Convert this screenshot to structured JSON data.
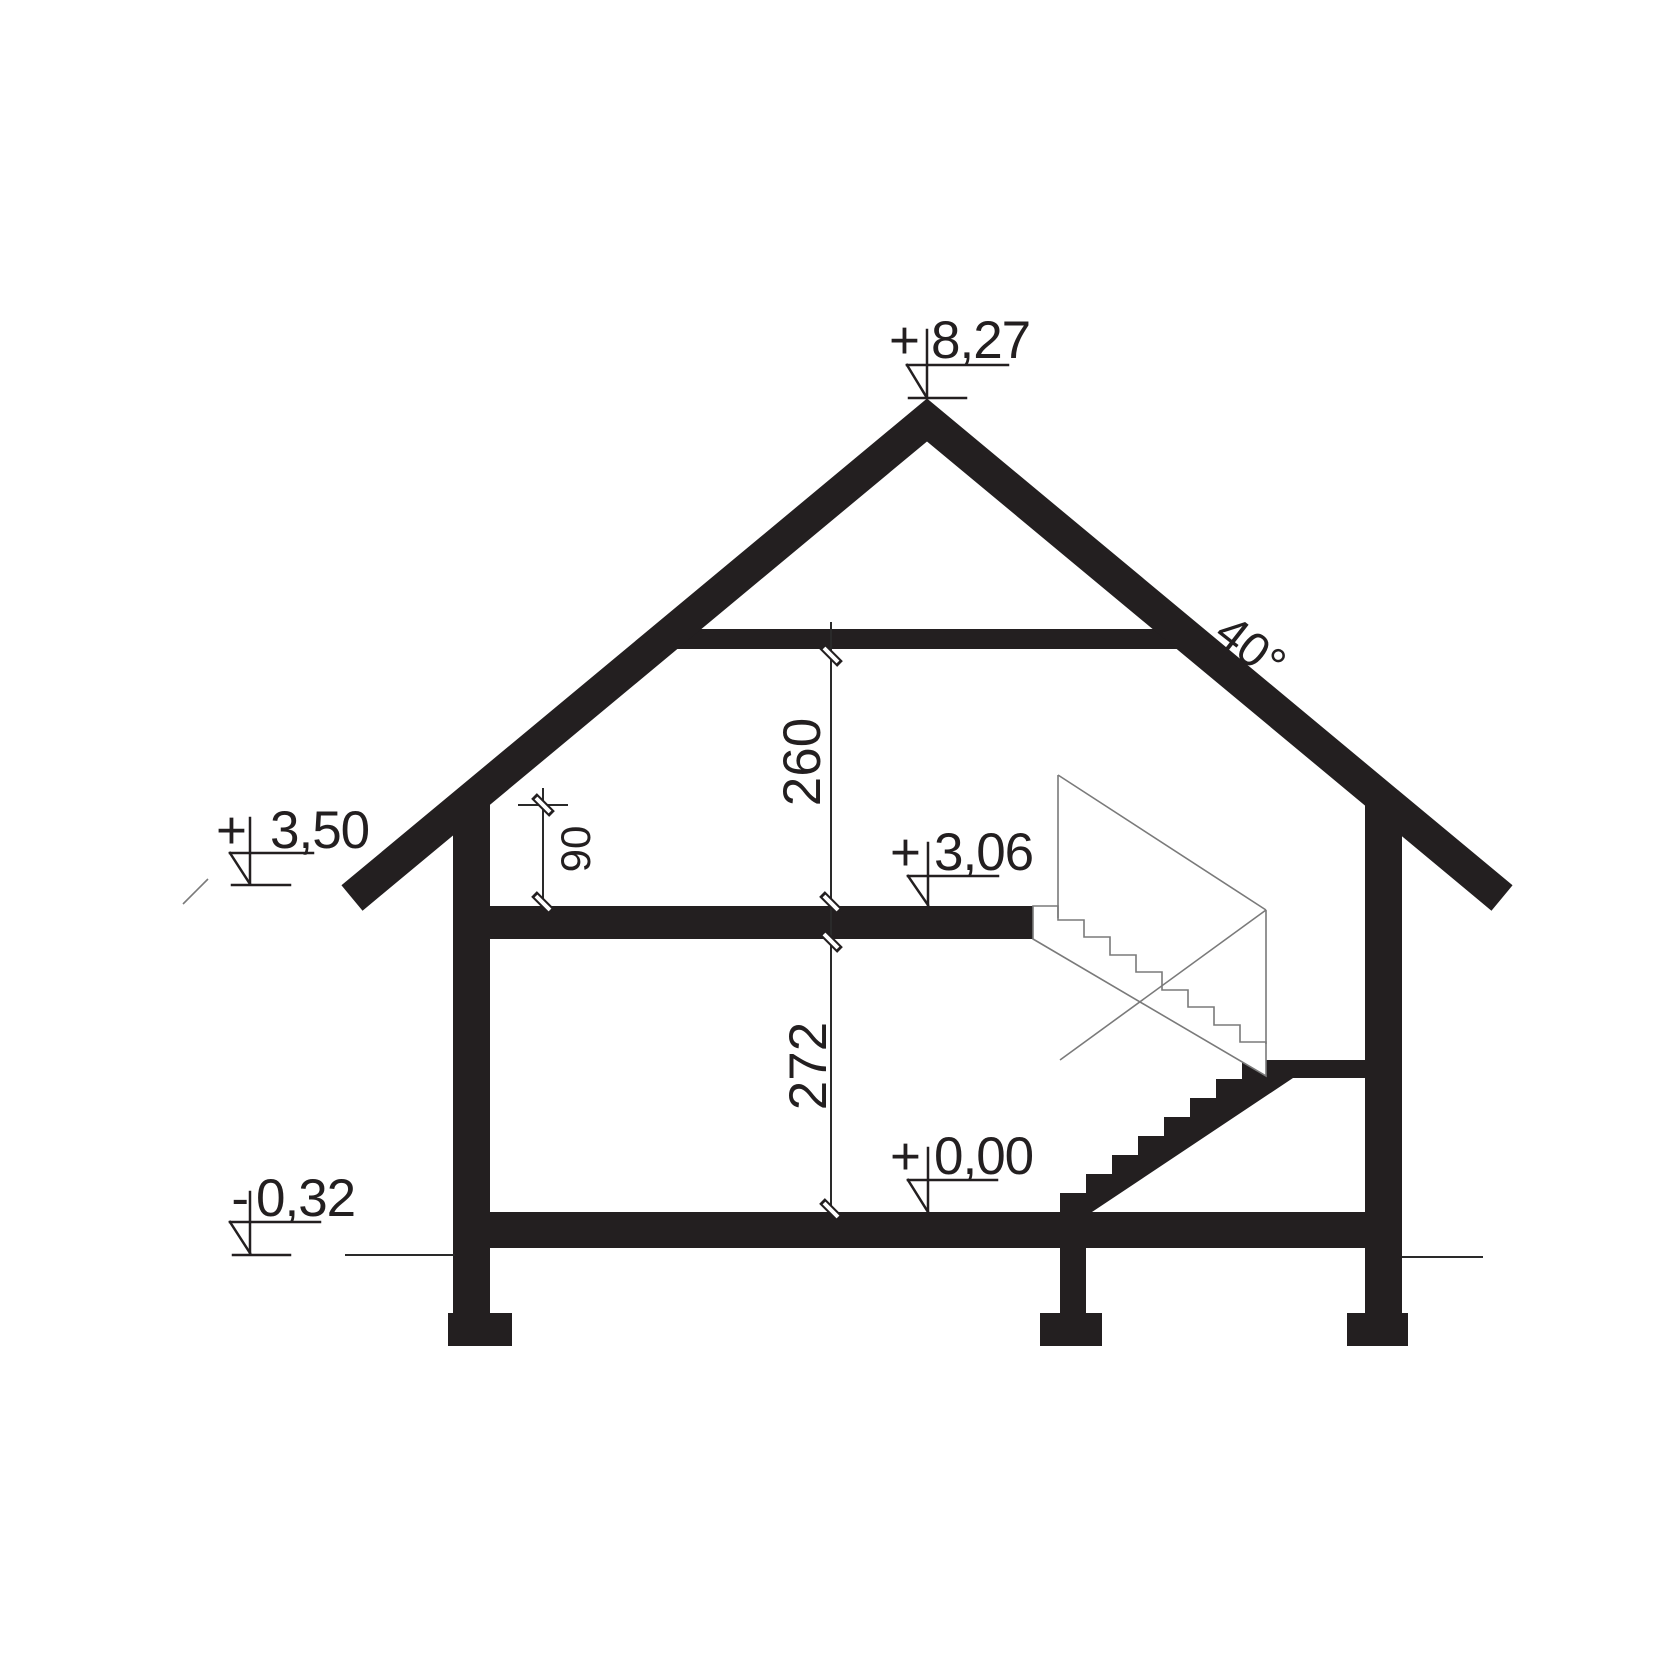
{
  "drawing": {
    "type": "house-cross-section",
    "ink_color": "#231f20",
    "thin_line_color": "#7a7a7a",
    "roof_angle_label": "40°",
    "levels": {
      "ridge": {
        "sign": "+",
        "value": "8,27"
      },
      "eaves": {
        "sign": "+",
        "value": "3,50"
      },
      "attic_floor": {
        "sign": "+",
        "value": "3,06"
      },
      "ground_floor": {
        "sign": "+",
        "value": "0,00"
      },
      "terrain": {
        "sign": "-",
        "value": "0,32"
      }
    },
    "dimensions": {
      "attic_height": "260",
      "knee_wall_height": "90",
      "ground_floor_height": "272"
    }
  }
}
